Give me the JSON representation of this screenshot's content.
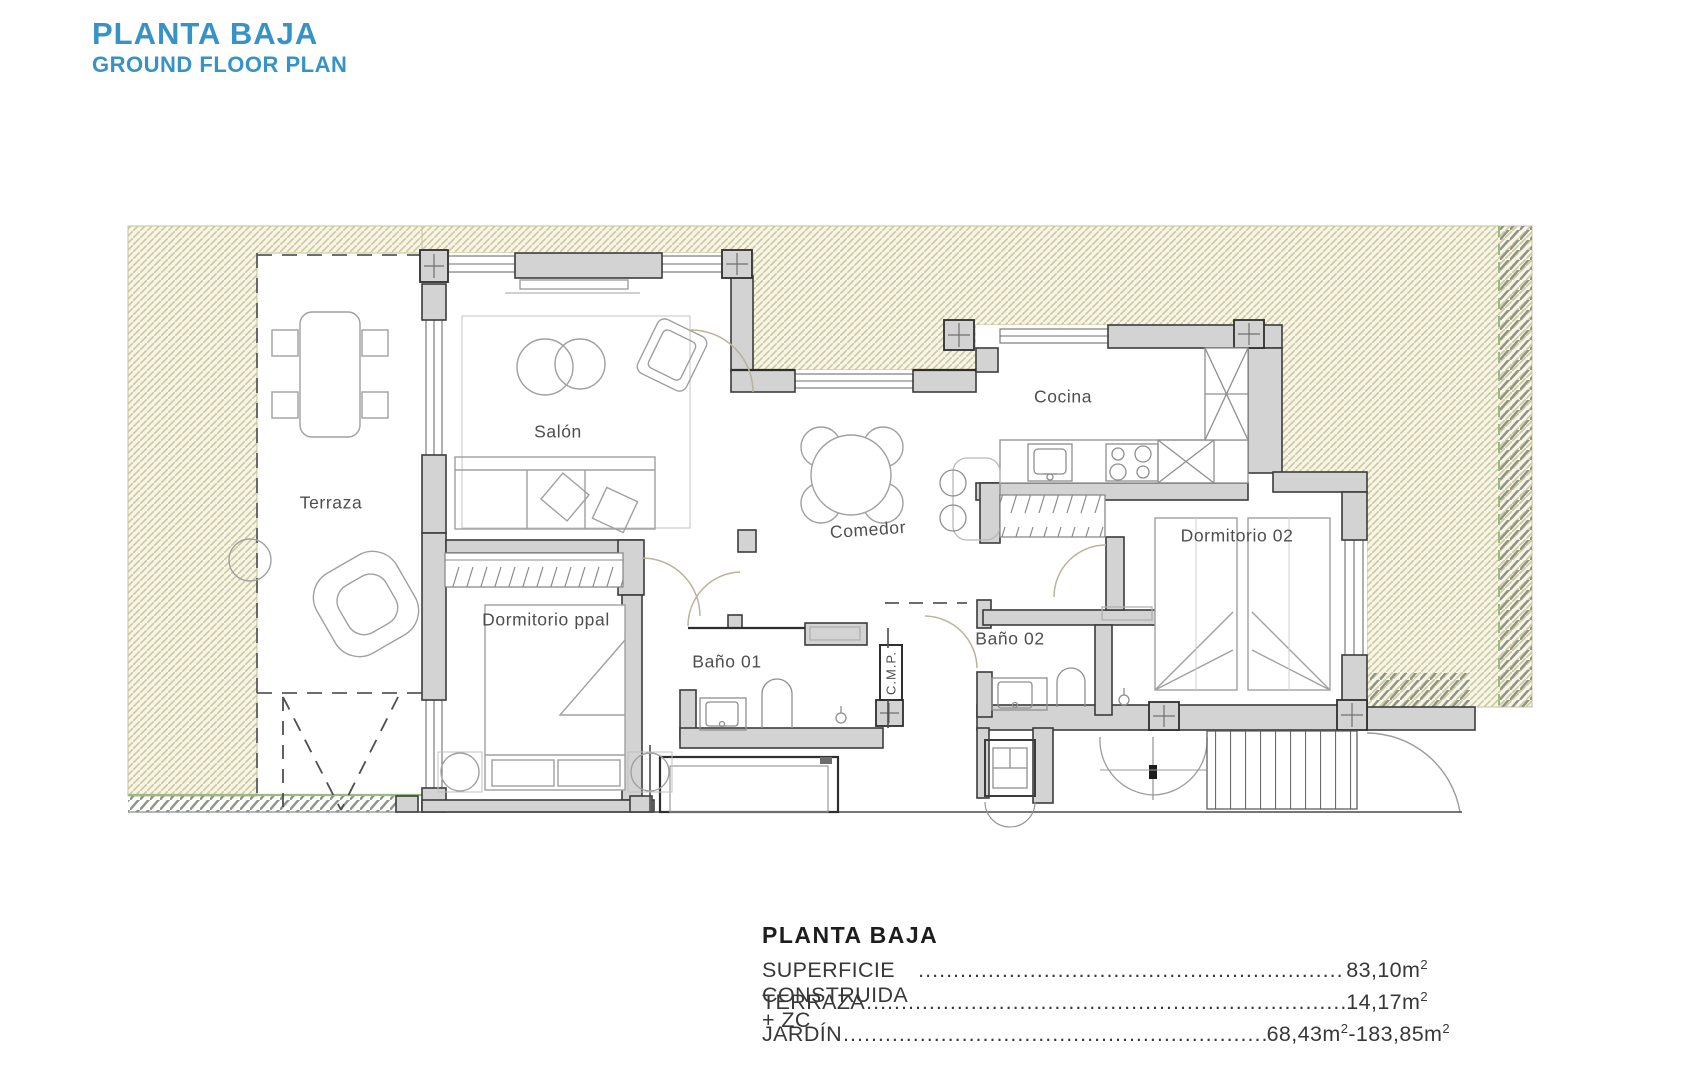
{
  "header": {
    "title": "PLANTA BAJA",
    "subtitle": "GROUND FLOOR PLAN"
  },
  "plan": {
    "rooms": [
      {
        "id": "terraza",
        "label": "Terraza"
      },
      {
        "id": "salon",
        "label": "Salón"
      },
      {
        "id": "cocina",
        "label": "Cocina"
      },
      {
        "id": "comedor",
        "label": "Comedor"
      },
      {
        "id": "dormitorio-ppal",
        "label": "Dormitorio ppal"
      },
      {
        "id": "bano-01",
        "label": "Baño 01"
      },
      {
        "id": "bano-02",
        "label": "Baño 02"
      },
      {
        "id": "dormitorio-02",
        "label": "Dormitorio 02"
      },
      {
        "id": "cmp",
        "label": "C.M.P."
      }
    ],
    "colors": {
      "accent_blue": "#3793c6",
      "garden_hatch": "#cdc9a3",
      "neighbor_hatch": "#8d9488",
      "wall_fill": "#d3d3d3",
      "boundary_green": "#9bb985"
    }
  },
  "summary": {
    "heading": "PLANTA BAJA",
    "lines": [
      {
        "label": "SUPERFICIE CONSTRUIDA + ZC",
        "value": "83,10m",
        "sup": "2"
      },
      {
        "label": "TERRAZA",
        "value": "14,17m",
        "sup": "2"
      },
      {
        "label": "JARDÍN",
        "value": "68,43m",
        "sup": "2",
        "value2": "-183,85m",
        "sup2": "2"
      }
    ]
  }
}
